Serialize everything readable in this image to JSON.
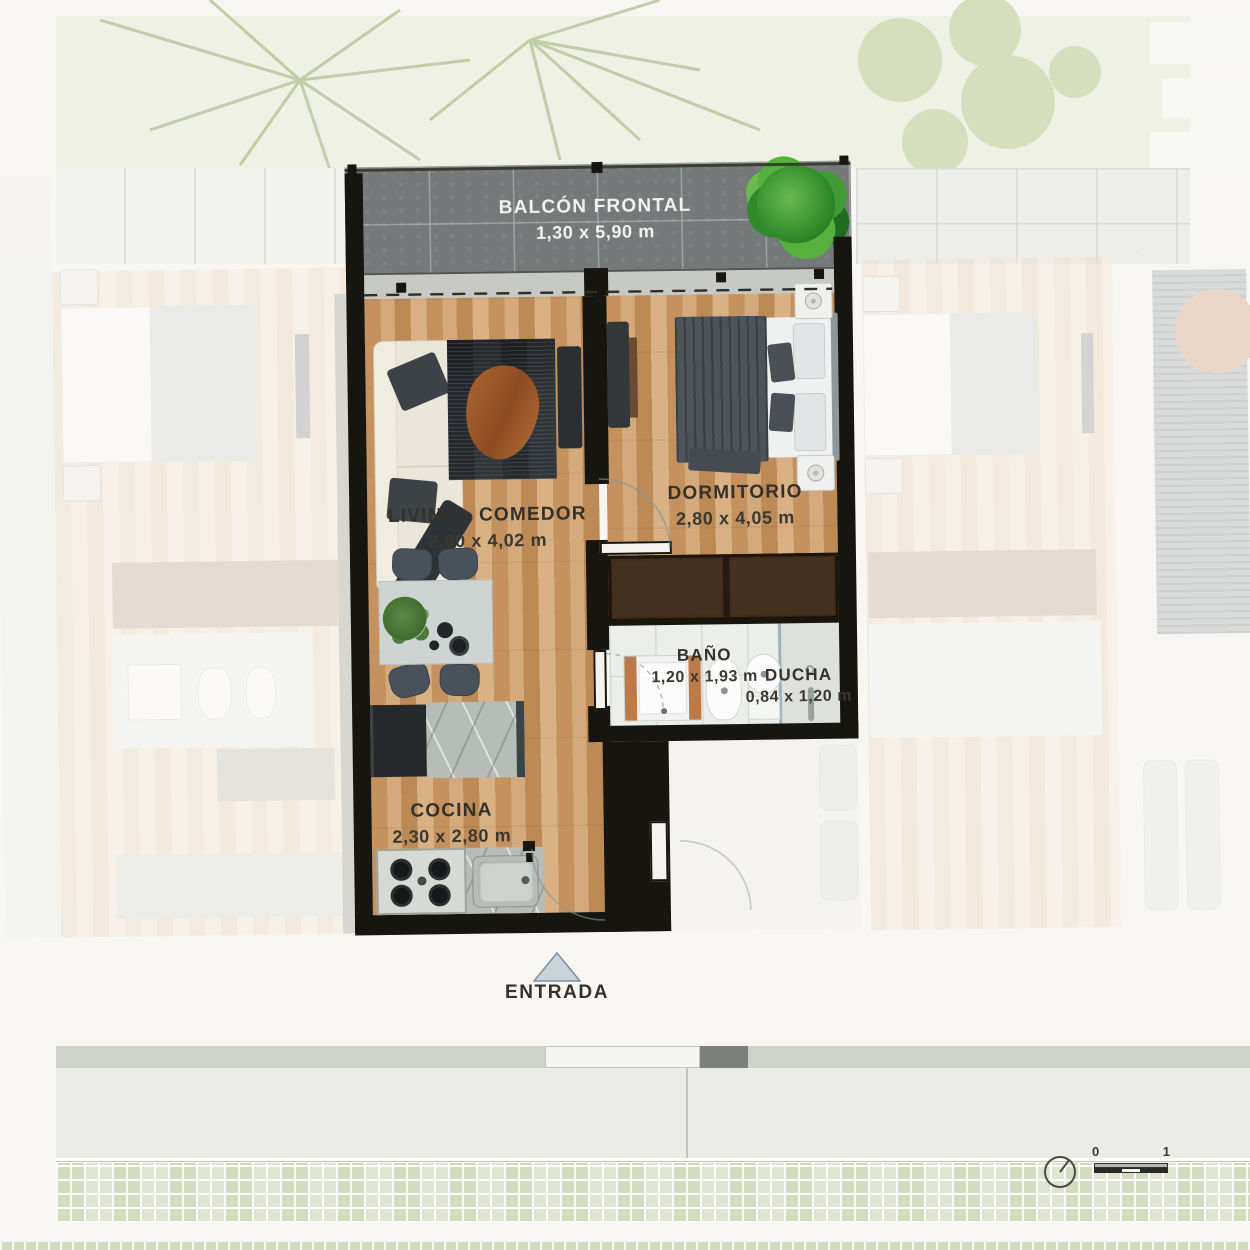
{
  "rooms": {
    "balcony": {
      "name": "BALCÓN FRONTAL",
      "dims": "1,30 x 5,90 m"
    },
    "living": {
      "name": "LIVING - COMEDOR",
      "dims": "2,80 x 4,02 m"
    },
    "bedroom": {
      "name": "DORMITORIO",
      "dims": "2,80 x 4,05 m"
    },
    "bathroom": {
      "name": "BAÑO",
      "dims": "1,20 x 1,93 m"
    },
    "shower": {
      "name": "DUCHA",
      "dims": "0,84 x 1,20 m"
    },
    "kitchen": {
      "name": "COCINA",
      "dims": "2,30 x 2,80 m"
    }
  },
  "entrance": {
    "label": "ENTRADA"
  },
  "scale_bar": {
    "start": "0",
    "end": "1"
  },
  "colors": {
    "wall": "#16150f",
    "wood": "#cb9c6e",
    "stone": "#75797a",
    "plant": "#3f9b32"
  }
}
